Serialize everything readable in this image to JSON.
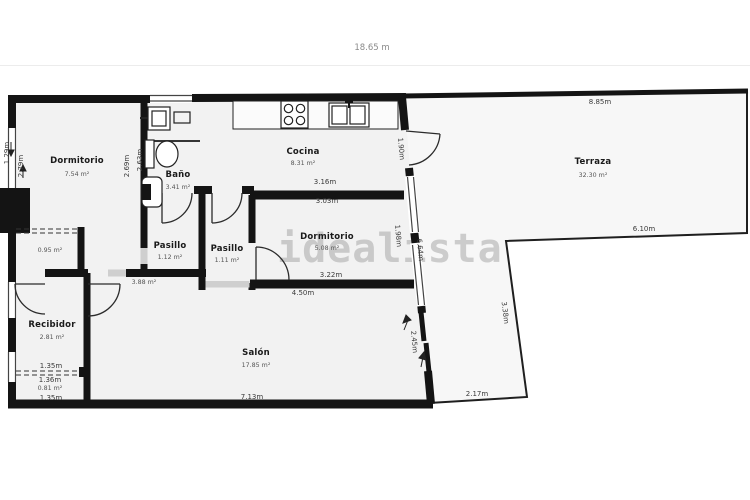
{
  "header": {
    "total_width_label": "18.65 m"
  },
  "watermark": "idealista",
  "rooms": {
    "dormitorio1": {
      "name": "Dormitorio",
      "area": "7.54 m²"
    },
    "bano": {
      "name": "Baño",
      "area": "3.41 m²"
    },
    "cocina": {
      "name": "Cocina",
      "area": "8.31 m²"
    },
    "terraza": {
      "name": "Terraza",
      "area": "32.30 m²"
    },
    "dormitorio2": {
      "name": "Dormitorio",
      "area": "5.08 m²"
    },
    "pasillo1": {
      "name": "Pasillo",
      "area": "1.12 m²"
    },
    "pasillo2": {
      "name": "Pasillo",
      "area": "1.11 m²"
    },
    "recibidor": {
      "name": "Recibidor",
      "area": "2.81 m²"
    },
    "salon": {
      "name": "Salón",
      "area": "17.85 m²"
    },
    "armario_dormitorio": {
      "area": "0.95 m²"
    },
    "rincon_salon": {
      "area": "3.88 m²"
    },
    "armario_recibidor": {
      "area": "0.81 m²"
    }
  },
  "dimensions": {
    "terraza_top": "8.85m",
    "terraza_inner_top": "6.10m",
    "terraza_inner_side": "3.38m",
    "terraza_bottom": "2.17m",
    "cocina_width": "3.16m",
    "dormitorio2_top": "3.03m",
    "dormitorio2_bottom": "3.22m",
    "salon_top": "4.50m",
    "salon_bottom": "7.13m",
    "cocina_door": "1.90m",
    "east_window": "1.98m",
    "east_wall": "6.64m",
    "salon_terraza_door": "2.45m",
    "dormitorio1_window": "1.29m",
    "dormitorio1_left": "2.79m",
    "dormitorio1_right": "2.69m",
    "bano_left": "2.63m",
    "recibidor_width": "1.35m",
    "armario_width": "1.36m",
    "armario_bottom": "1.35m"
  }
}
